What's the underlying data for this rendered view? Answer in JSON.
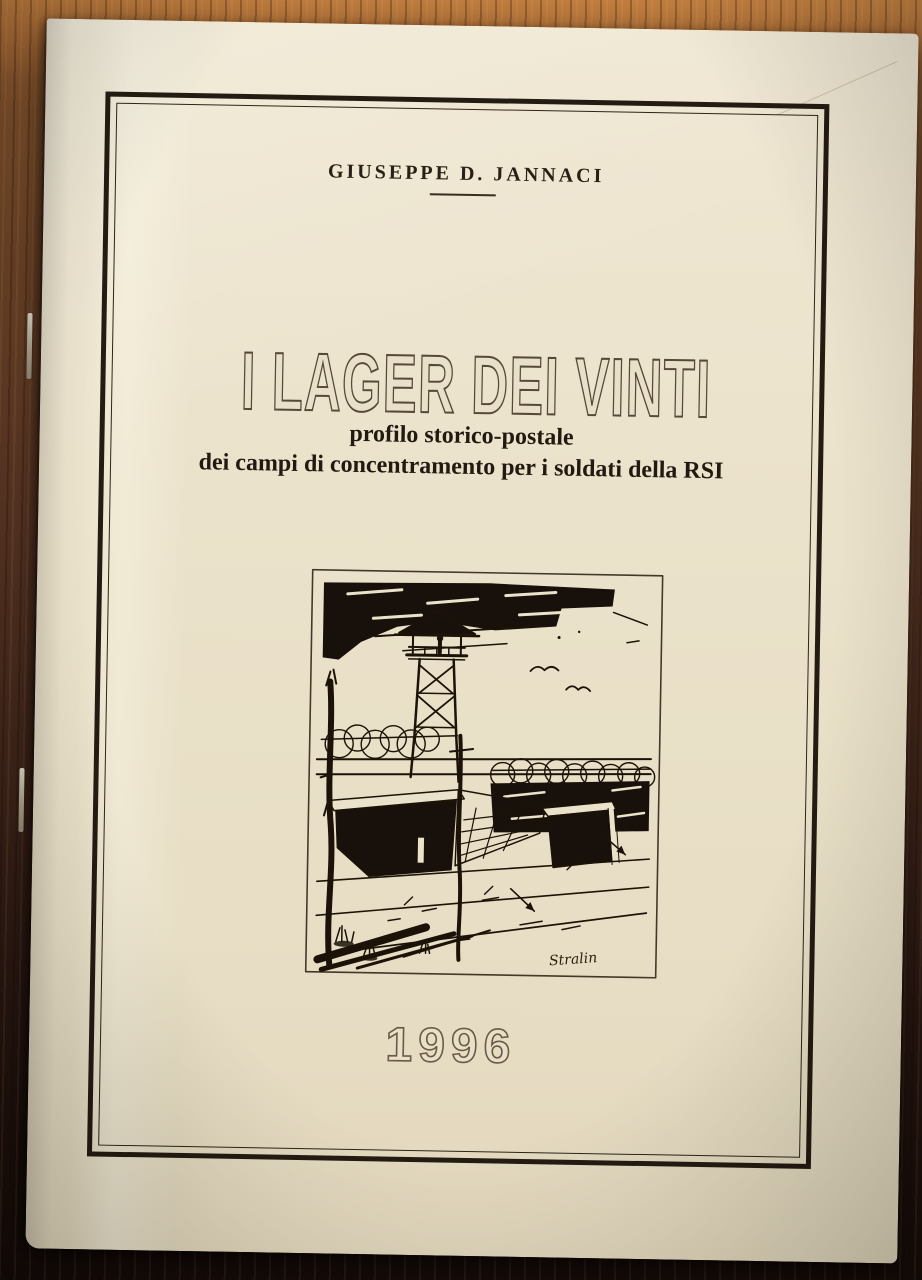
{
  "photo": {
    "description": "Photograph of a stapled booklet lying on a wooden table",
    "colors": {
      "table_wood_light": "#a96f3a",
      "table_wood_dark": "#1d100b",
      "cover_paper": "#e9e0c9",
      "frame_line": "#241b12",
      "ink": "#1c1207",
      "outline_lettering": "#57493a"
    }
  },
  "cover": {
    "author": "GIUSEPPE D. JANNACI",
    "title": "I LAGER DEI VINTI",
    "subtitle_line1": "profilo storico-postale",
    "subtitle_line2": "dei campi di concentramento per i soldati della RSI",
    "year": "1996",
    "illustration": {
      "description": "Ink sketch of a prison camp: watchtower with guard, barbed-wire fences, barrack huts, birds in the sky",
      "signature": "Stralin"
    }
  }
}
